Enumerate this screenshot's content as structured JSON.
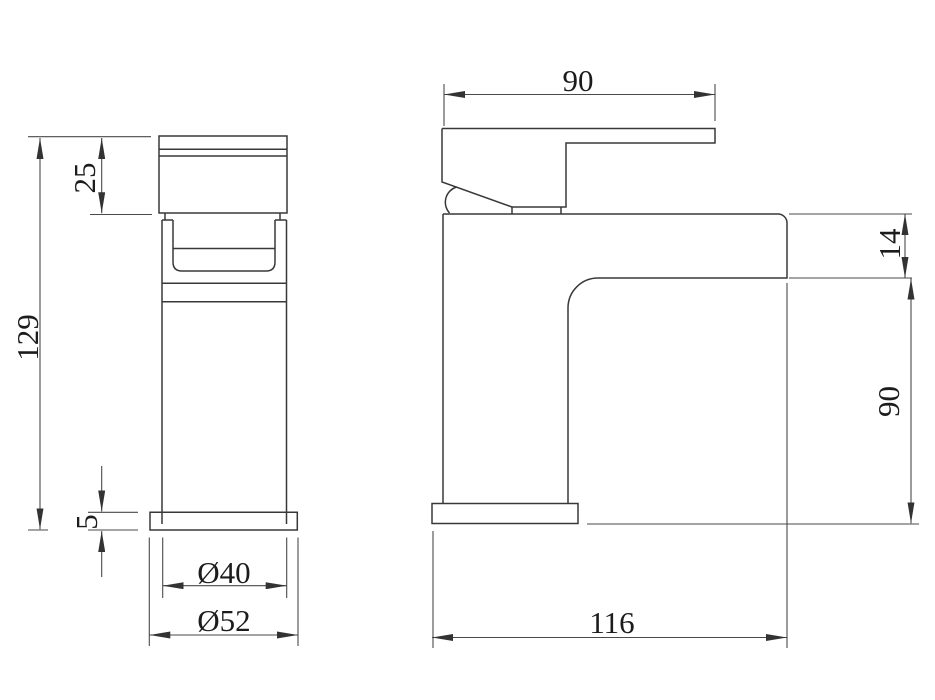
{
  "drawing": {
    "type": "technical-dimension-drawing",
    "subject": "basin mixer tap, front and side orthographic views",
    "background_color": "#ffffff",
    "line_color": "#383838",
    "views": {
      "front": {
        "label": "front-view",
        "dims": {
          "head_height": "25",
          "overall_height": "129",
          "base_thickness": "5",
          "body_diameter": "Ø40",
          "base_diameter": "Ø52"
        }
      },
      "side": {
        "label": "side-view",
        "dims": {
          "handle_length": "90",
          "spout_thickness": "14",
          "body_height": "90",
          "overall_depth": "116"
        }
      }
    }
  }
}
